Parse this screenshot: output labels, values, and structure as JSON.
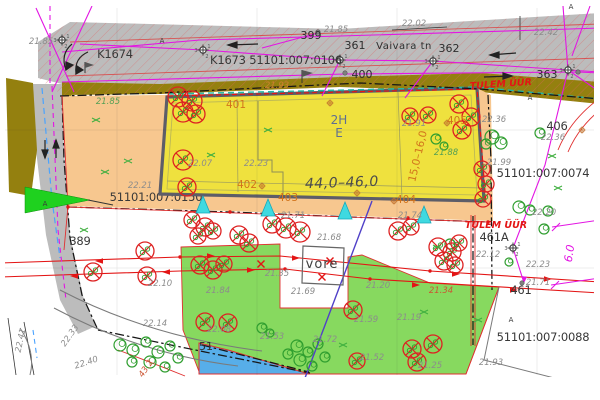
{
  "map": {
    "title": "Detail plan — Vaivara tn",
    "colors": {
      "road": "#bcbcbc",
      "verge": "#94800f",
      "parcel_orange": "#f7c78f",
      "building": "#efe13e",
      "building_border": "#5d5d68",
      "green_area": "#87d95f",
      "water": "#57aee9",
      "hatch": "#e06565",
      "remove": "#dd2222",
      "tree": "#2f9e2f",
      "cyan": "#3fd9e0",
      "magenta": "#e316e3",
      "red_line": "#e31515",
      "boundary": "#161616"
    },
    "labels": [
      {
        "t": "K1674",
        "x": 115,
        "y": 58,
        "c": "p",
        "n": "label-k1674"
      },
      {
        "t": "K1673 51101:007:0106",
        "x": 276,
        "y": 64,
        "c": "p",
        "n": "cadastral-number-0106"
      },
      {
        "t": "399",
        "x": 311,
        "y": 39,
        "c": "d",
        "n": "address-399"
      },
      {
        "t": "22.02",
        "x": 414,
        "y": 26,
        "c": "e"
      },
      {
        "t": "21.85",
        "x": 336,
        "y": 32,
        "c": "e"
      },
      {
        "t": "361",
        "x": 355,
        "y": 49,
        "c": "d",
        "n": "address-361"
      },
      {
        "t": "Vaivara tn",
        "x": 404,
        "y": 49,
        "c": "s",
        "n": "street-name"
      },
      {
        "t": "362",
        "x": 449,
        "y": 52,
        "c": "d",
        "n": "address-362"
      },
      {
        "t": "400",
        "x": 362,
        "y": 78,
        "c": "d",
        "n": "address-400"
      },
      {
        "t": "363",
        "x": 547,
        "y": 78,
        "c": "d",
        "n": "address-363"
      },
      {
        "t": "22.42",
        "x": 546,
        "y": 35,
        "c": "e"
      },
      {
        "t": "21.85",
        "x": 41,
        "y": 44,
        "c": "e"
      },
      {
        "t": "TULEM ÜÜR",
        "x": 501,
        "y": 87,
        "c": "r",
        "r": -4,
        "n": "firewall-label-top"
      },
      {
        "t": "21.93",
        "x": 277,
        "y": 88,
        "c": "oe"
      },
      {
        "t": "21.85",
        "x": 108,
        "y": 104,
        "c": "g"
      },
      {
        "t": "22.21",
        "x": 140,
        "y": 188,
        "c": "e"
      },
      {
        "t": "51101:007:0150",
        "x": 156,
        "y": 201,
        "c": "p",
        "u": 1,
        "n": "cadastral-number-0150"
      },
      {
        "t": "389",
        "x": 80,
        "y": 245,
        "c": "p",
        "n": "address-389"
      },
      {
        "t": "22.10",
        "x": 160,
        "y": 286,
        "c": "e"
      },
      {
        "t": "21.84",
        "x": 218,
        "y": 293,
        "c": "e"
      },
      {
        "t": "22.14",
        "x": 155,
        "y": 326,
        "c": "e"
      },
      {
        "t": "22.08",
        "x": 219,
        "y": 332,
        "c": "e"
      },
      {
        "t": "21.53",
        "x": 272,
        "y": 339,
        "c": "e"
      },
      {
        "t": "21.72",
        "x": 325,
        "y": 342,
        "c": "e"
      },
      {
        "t": "21.59",
        "x": 366,
        "y": 322,
        "c": "e"
      },
      {
        "t": "21.19",
        "x": 409,
        "y": 320,
        "c": "e"
      },
      {
        "t": "21.52",
        "x": 372,
        "y": 360,
        "c": "e"
      },
      {
        "t": "21.25",
        "x": 430,
        "y": 368,
        "c": "e"
      },
      {
        "t": "21.69",
        "x": 303,
        "y": 294,
        "c": "e"
      },
      {
        "t": "21.68",
        "x": 329,
        "y": 240,
        "c": "e"
      },
      {
        "t": "21.71",
        "x": 293,
        "y": 218,
        "c": "e"
      },
      {
        "t": "21.74",
        "x": 410,
        "y": 218,
        "c": "e"
      },
      {
        "t": "21.35",
        "x": 277,
        "y": 276,
        "c": "e"
      },
      {
        "t": "21.20",
        "x": 378,
        "y": 288,
        "c": "e"
      },
      {
        "t": "22.07",
        "x": 200,
        "y": 166,
        "c": "e"
      },
      {
        "t": "22.23",
        "x": 256,
        "y": 166,
        "c": "e"
      },
      {
        "t": "401",
        "x": 236,
        "y": 108,
        "c": "o",
        "n": "building-point-401"
      },
      {
        "t": "402",
        "x": 247,
        "y": 188,
        "c": "o",
        "n": "building-point-402"
      },
      {
        "t": "403",
        "x": 288,
        "y": 201,
        "c": "o",
        "n": "building-point-403"
      },
      {
        "t": "404",
        "x": 406,
        "y": 203,
        "c": "o",
        "n": "building-point-404"
      },
      {
        "t": "405",
        "x": 457,
        "y": 124,
        "c": "o",
        "n": "building-point-405"
      },
      {
        "t": "21.91",
        "x": 414,
        "y": 126,
        "c": "e"
      },
      {
        "t": "21.88",
        "x": 446,
        "y": 155,
        "c": "g"
      },
      {
        "t": "2H",
        "x": 339,
        "y": 124,
        "c": "b",
        "n": "building-storeys"
      },
      {
        "t": "E",
        "x": 339,
        "y": 137,
        "c": "b",
        "n": "building-use"
      },
      {
        "t": "44,0–46,0",
        "x": 342,
        "y": 187,
        "c": "w",
        "r": -2,
        "n": "building-dimension-length"
      },
      {
        "t": "15,0–16,0",
        "x": 421,
        "y": 157,
        "c": "o",
        "r": -77,
        "n": "building-dimension-width"
      },
      {
        "t": "22.36",
        "x": 494,
        "y": 122,
        "c": "e"
      },
      {
        "t": "406",
        "x": 557,
        "y": 130,
        "c": "p",
        "n": "address-406"
      },
      {
        "t": "22.36",
        "x": 553,
        "y": 140,
        "c": "e"
      },
      {
        "t": "21.99",
        "x": 499,
        "y": 165,
        "c": "e"
      },
      {
        "t": "51101:007:0074",
        "x": 543,
        "y": 177,
        "c": "p",
        "n": "cadastral-number-0074"
      },
      {
        "t": "TULEM ÜÜR",
        "x": 496,
        "y": 228,
        "c": "r",
        "n": "firewall-label-right"
      },
      {
        "t": "461A",
        "x": 494,
        "y": 241,
        "c": "p",
        "n": "address-461a"
      },
      {
        "t": "22.12",
        "x": 488,
        "y": 257,
        "c": "e"
      },
      {
        "t": "22.20",
        "x": 544,
        "y": 215,
        "c": "e"
      },
      {
        "t": "22.23",
        "x": 538,
        "y": 267,
        "c": "e"
      },
      {
        "t": "21.71",
        "x": 538,
        "y": 285,
        "c": "e"
      },
      {
        "t": "461",
        "x": 521,
        "y": 294,
        "c": "p",
        "n": "address-461"
      },
      {
        "t": "A",
        "x": 511,
        "y": 322,
        "c": "a"
      },
      {
        "t": "51101:007:0088",
        "x": 543,
        "y": 341,
        "c": "p",
        "n": "cadastral-number-0088"
      },
      {
        "t": "21.93",
        "x": 491,
        "y": 365,
        "c": "e"
      },
      {
        "t": "21.34",
        "x": 441,
        "y": 293,
        "c": "re"
      },
      {
        "t": "6.0",
        "x": 573,
        "y": 254,
        "c": "m",
        "r": -81,
        "n": "dimension-6-0"
      },
      {
        "t": "vore",
        "x": 322,
        "y": 268,
        "c": "v",
        "n": "grate-label"
      },
      {
        "t": "22.41",
        "x": 23,
        "y": 341,
        "c": "e",
        "r": -78
      },
      {
        "t": "22.33",
        "x": 72,
        "y": 337,
        "c": "e",
        "r": -55
      },
      {
        "t": "22.40",
        "x": 87,
        "y": 365,
        "c": "e",
        "r": -18
      },
      {
        "t": "43.2",
        "x": 148,
        "y": 370,
        "c": "re",
        "r": -55
      },
      {
        "t": "51",
        "x": 206,
        "y": 350,
        "c": "d"
      },
      {
        "t": "A",
        "x": 162,
        "y": 43,
        "c": "a"
      },
      {
        "t": "A",
        "x": 45,
        "y": 206,
        "c": "a"
      },
      {
        "t": "A",
        "x": 530,
        "y": 100,
        "c": "a"
      },
      {
        "t": "A",
        "x": 571,
        "y": 9,
        "c": "a"
      }
    ],
    "trees": [
      [
        492,
        137,
        7
      ],
      [
        501,
        143,
        6
      ],
      [
        486,
        144,
        5
      ],
      [
        540,
        133,
        5
      ],
      [
        548,
        211,
        5
      ],
      [
        544,
        229,
        5
      ],
      [
        519,
        207,
        6
      ],
      [
        530,
        210,
        5
      ],
      [
        450,
        244,
        5
      ],
      [
        509,
        262,
        4
      ],
      [
        436,
        139,
        5
      ],
      [
        444,
        146,
        4
      ],
      [
        120,
        345,
        6
      ],
      [
        133,
        350,
        6
      ],
      [
        146,
        342,
        5
      ],
      [
        158,
        352,
        6
      ],
      [
        170,
        346,
        5
      ],
      [
        150,
        362,
        6
      ],
      [
        132,
        362,
        5
      ],
      [
        165,
        367,
        5
      ],
      [
        178,
        358,
        5
      ],
      [
        297,
        346,
        6
      ],
      [
        308,
        352,
        5
      ],
      [
        318,
        344,
        5
      ],
      [
        300,
        360,
        6
      ],
      [
        312,
        366,
        5
      ],
      [
        325,
        357,
        5
      ],
      [
        288,
        354,
        5
      ],
      [
        262,
        328,
        5
      ],
      [
        270,
        333,
        4
      ]
    ],
    "trees_removed": [
      [
        178,
        97,
        10
      ],
      [
        192,
        101,
        10
      ],
      [
        183,
        112,
        10
      ],
      [
        196,
        114,
        9
      ],
      [
        183,
        160,
        10
      ],
      [
        187,
        187,
        9
      ],
      [
        239,
        235,
        9
      ],
      [
        249,
        243,
        9
      ],
      [
        272,
        224,
        9
      ],
      [
        286,
        228,
        10
      ],
      [
        300,
        232,
        10
      ],
      [
        192,
        220,
        8
      ],
      [
        205,
        227,
        9
      ],
      [
        198,
        236,
        8
      ],
      [
        213,
        231,
        8
      ],
      [
        145,
        251,
        9
      ],
      [
        93,
        272,
        9
      ],
      [
        147,
        276,
        9
      ],
      [
        200,
        265,
        9
      ],
      [
        213,
        270,
        9
      ],
      [
        224,
        264,
        8
      ],
      [
        410,
        116,
        8
      ],
      [
        428,
        115,
        8
      ],
      [
        459,
        104,
        9
      ],
      [
        471,
        117,
        9
      ],
      [
        462,
        130,
        9
      ],
      [
        482,
        169,
        8
      ],
      [
        486,
        184,
        8
      ],
      [
        483,
        199,
        8
      ],
      [
        398,
        231,
        9
      ],
      [
        411,
        227,
        8
      ],
      [
        438,
        247,
        9
      ],
      [
        452,
        252,
        9
      ],
      [
        444,
        261,
        9
      ],
      [
        459,
        243,
        8
      ],
      [
        455,
        265,
        8
      ],
      [
        205,
        322,
        9
      ],
      [
        228,
        323,
        9
      ],
      [
        353,
        310,
        9
      ],
      [
        357,
        361,
        8
      ],
      [
        412,
        349,
        9
      ],
      [
        417,
        362,
        9
      ],
      [
        433,
        344,
        9
      ]
    ],
    "bushes": [
      [
        105,
        172
      ],
      [
        84,
        230
      ],
      [
        211,
        155
      ],
      [
        268,
        130
      ],
      [
        437,
        247
      ],
      [
        478,
        320
      ],
      [
        424,
        312
      ],
      [
        343,
        345
      ],
      [
        558,
        188
      ],
      [
        552,
        156
      ],
      [
        96,
        120
      ],
      [
        128,
        161
      ]
    ],
    "stations": [
      [
        62,
        40
      ],
      [
        203,
        50
      ],
      [
        340,
        60
      ],
      [
        433,
        61
      ],
      [
        568,
        70
      ],
      [
        513,
        248
      ]
    ],
    "station_small": [
      [
        262,
        186
      ],
      [
        357,
        193
      ],
      [
        394,
        201
      ],
      [
        447,
        123
      ],
      [
        582,
        130
      ],
      [
        330,
        103
      ]
    ],
    "points": [
      [
        318,
        32
      ],
      [
        345,
        73
      ],
      [
        578,
        72
      ],
      [
        522,
        283
      ]
    ],
    "entrances": [
      [
        203,
        196
      ],
      [
        268,
        199
      ],
      [
        345,
        202
      ],
      [
        424,
        206
      ]
    ],
    "valves": [
      [
        261,
        264
      ],
      [
        330,
        261
      ],
      [
        322,
        277
      ]
    ],
    "flow_arrows": [
      [
        95,
        261,
        -1
      ],
      [
        215,
        256,
        1
      ],
      [
        300,
        258,
        1
      ],
      [
        460,
        274,
        1
      ],
      [
        552,
        279,
        1
      ],
      [
        70,
        276,
        -1
      ],
      [
        162,
        272,
        -1
      ],
      [
        255,
        270,
        1
      ],
      [
        420,
        285,
        1
      ],
      [
        518,
        290,
        1
      ]
    ],
    "line_points": [
      [
        180,
        257
      ],
      [
        430,
        271
      ],
      [
        285,
        269
      ],
      [
        370,
        279
      ],
      [
        68,
        207
      ],
      [
        488,
        222
      ],
      [
        230,
        212
      ],
      [
        408,
        218
      ]
    ]
  }
}
